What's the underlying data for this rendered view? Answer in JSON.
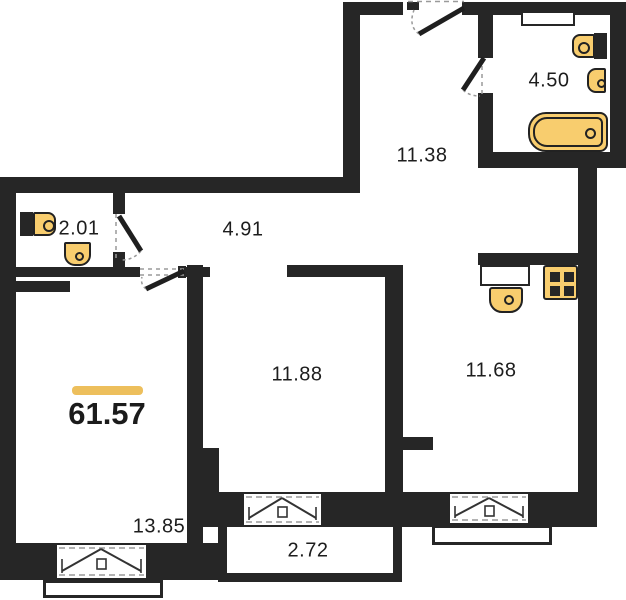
{
  "plan_title": "Apartment floor plan",
  "total_area": "61.57",
  "rooms": {
    "hall": "11.38",
    "bathroom": "4.50",
    "wc": "2.01",
    "corridor": "4.91",
    "living": "11.88",
    "kitchen": "11.68",
    "bedroom": "13.85",
    "balcony": "2.72"
  },
  "fixtures": {
    "bathroom": [
      "toilet",
      "sink",
      "bathtub"
    ],
    "wc": [
      "toilet",
      "sink"
    ],
    "kitchen": [
      "sink",
      "stove"
    ]
  },
  "colors": {
    "wall": "#262626",
    "fixture_fill": "#f8cd6e",
    "accent_bar": "#edbf5c",
    "background": "#ffffff",
    "label_text": "#1d1d1d"
  }
}
